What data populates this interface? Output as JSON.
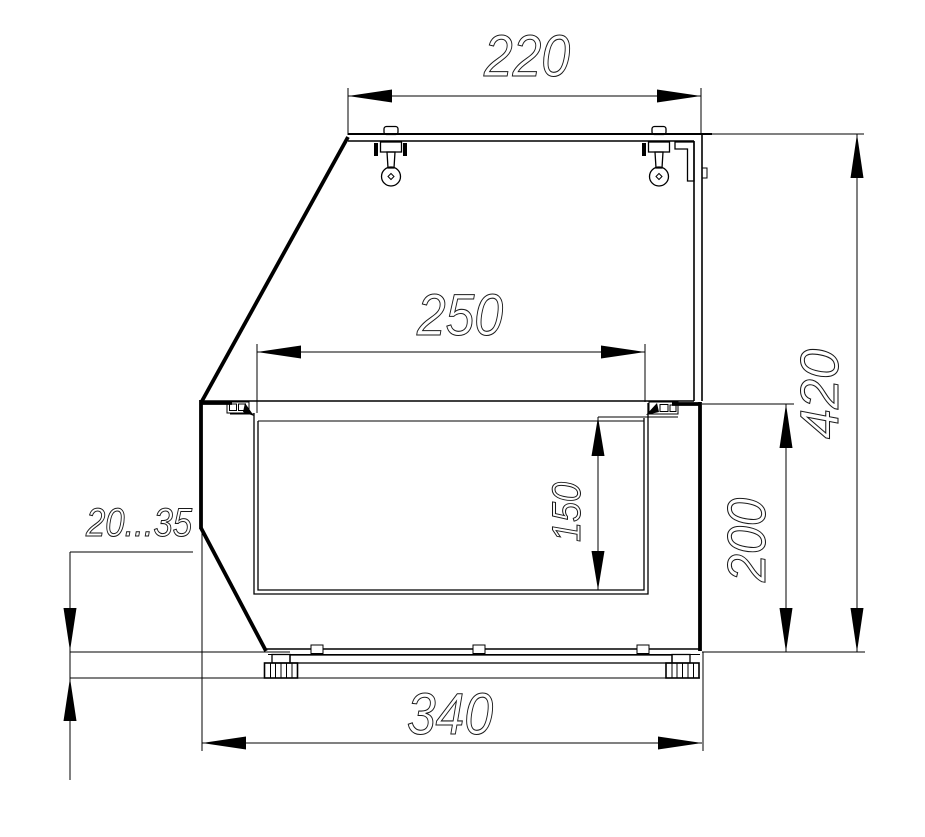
{
  "drawing": {
    "kind": "technical cross-section drawing",
    "colors": {
      "background": "#ffffff",
      "line": "#000000",
      "lettering": "#1a1a1a"
    },
    "dimensions": {
      "top_shelf_width": "220",
      "well_opening_width": "250",
      "well_depth": "150",
      "body_height": "200",
      "overall_height": "420",
      "base_depth": "340",
      "foot_adjustment_range": "20...35"
    }
  }
}
